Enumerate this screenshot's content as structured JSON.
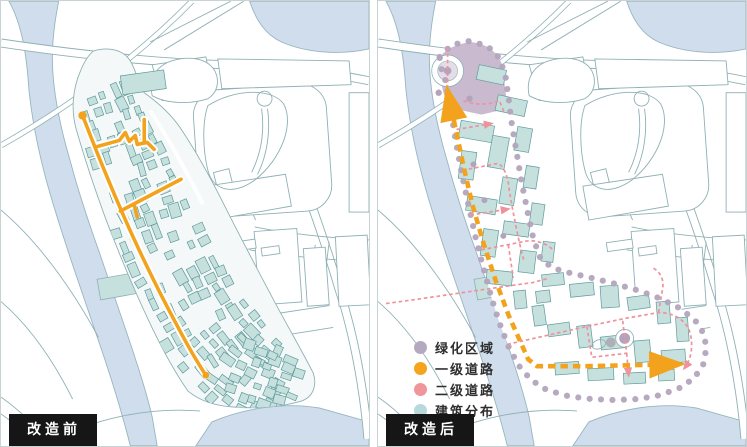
{
  "panels": [
    {
      "id": "before",
      "label": "改造前"
    },
    {
      "id": "after",
      "label": "改造后"
    }
  ],
  "legend": {
    "items": [
      {
        "name": "green-area",
        "label": "绿化区域",
        "color": "#b5a9bf"
      },
      {
        "name": "primary-road",
        "label": "一级道路",
        "color": "#f5a41e"
      },
      {
        "name": "secondary-road",
        "label": "二级道路",
        "color": "#f0959c"
      },
      {
        "name": "building-distribution",
        "label": "建筑分布",
        "color": "#b7d9dc"
      }
    ]
  },
  "colors": {
    "water": "#cfddec",
    "water_line": "#97b5c0",
    "map_line": "#8fb0b4",
    "building_fill": "#c6e0de",
    "building_stroke": "#5f9a9c",
    "primary_road": "#f2a21c",
    "secondary_road": "#ee929b",
    "green_fill": "#c4b3ca",
    "green_dot": "#b2a4bd",
    "label_bg": "#161616",
    "label_text": "#ffffff"
  }
}
